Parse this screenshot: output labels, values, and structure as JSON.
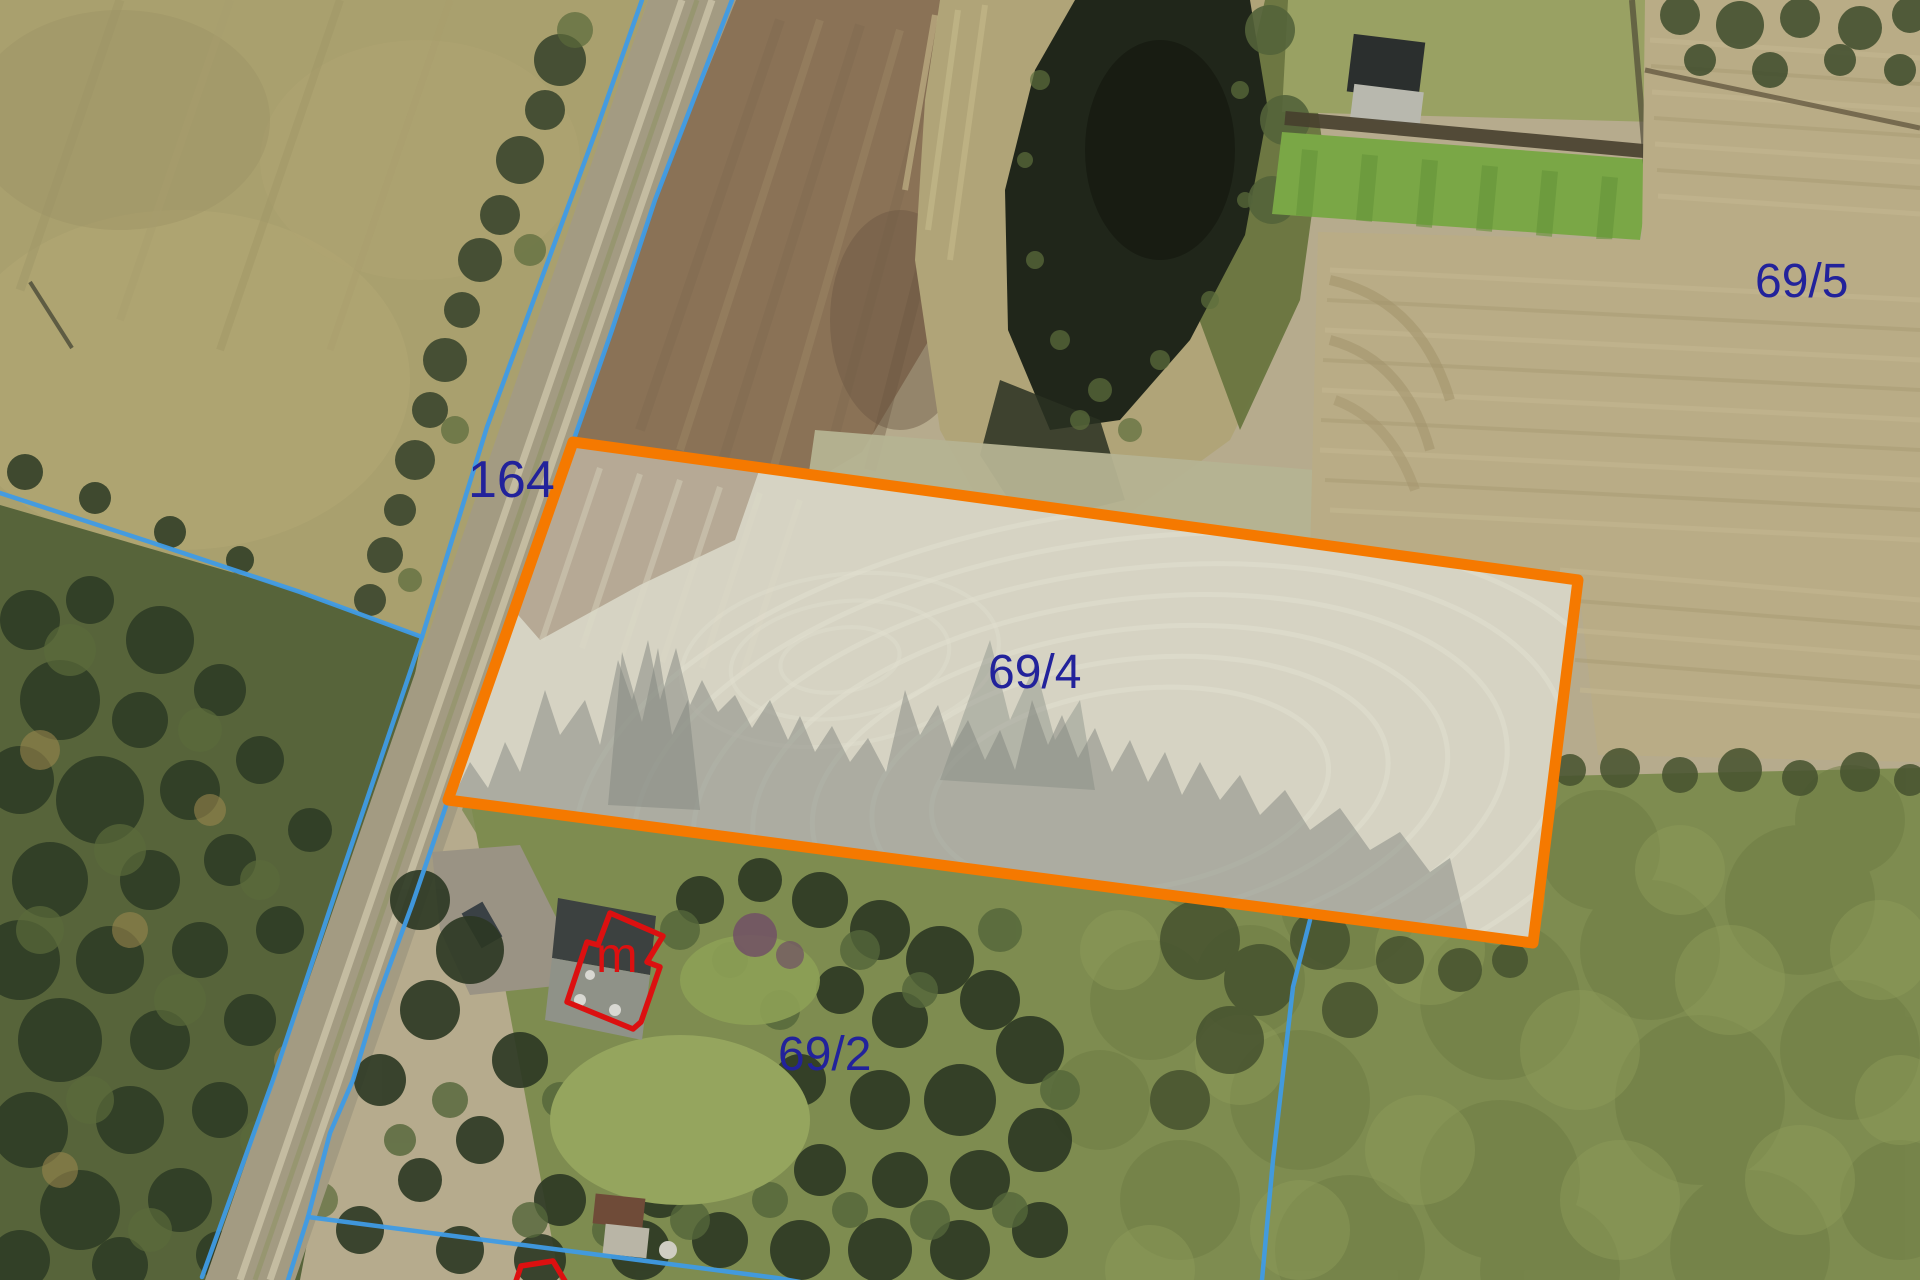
{
  "map": {
    "type": "aerial-cadastral-map",
    "highlighted_parcel_id": "69/4",
    "labels": {
      "road_parcel": "164",
      "parcel_ne": "69/5",
      "parcel_highlighted": "69/4",
      "parcel_south": "69/2",
      "building_mark": "m"
    },
    "colors": {
      "boundary_line": "#3f9be5",
      "highlight_outline": "#f57900",
      "highlight_fill": "rgba(255,255,255,0.30)",
      "building_outline": "#dc1010",
      "label_text": "#22229b",
      "building_label_text": "#dc1010"
    }
  }
}
